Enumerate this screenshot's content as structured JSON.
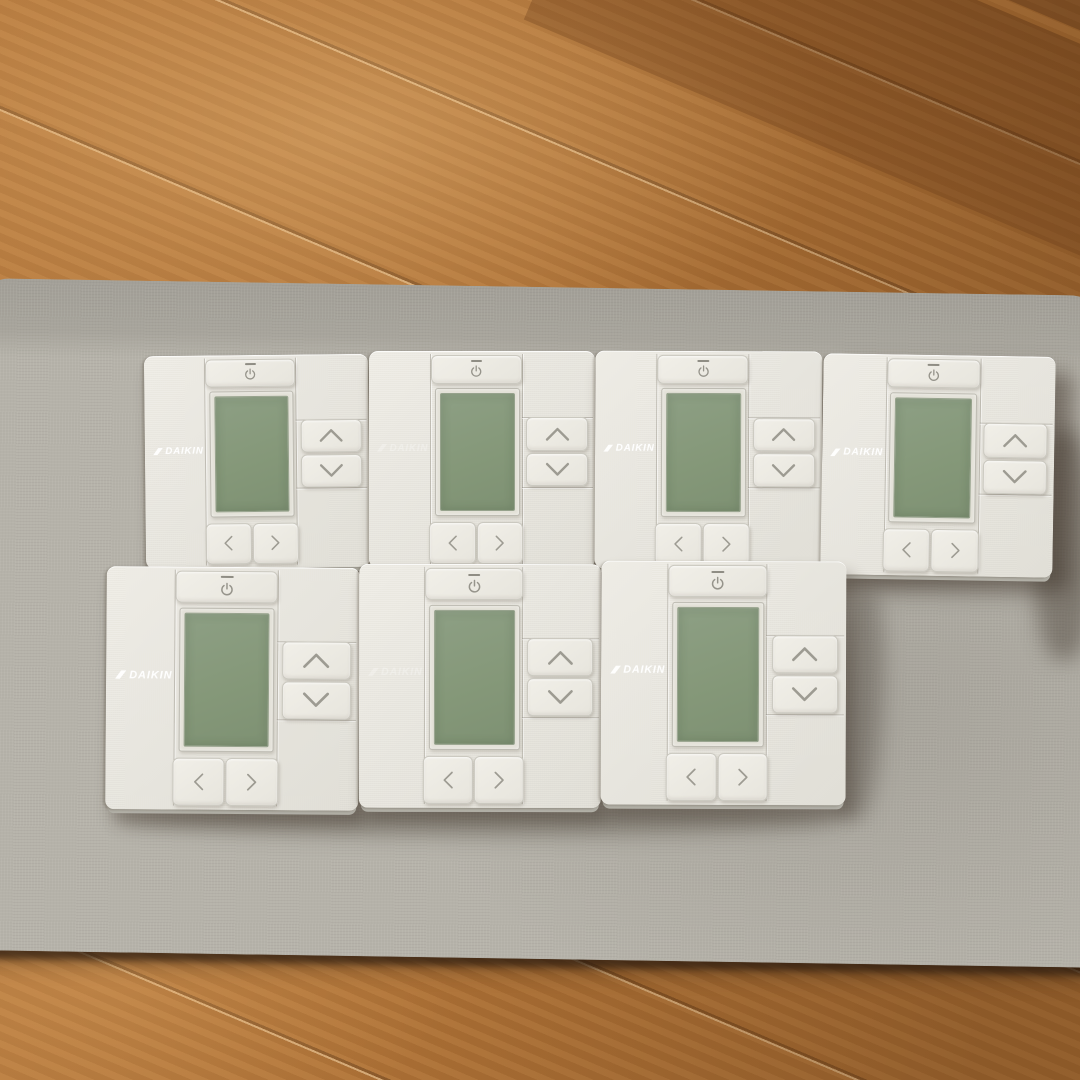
{
  "scene": {
    "description": "Seven DAIKIN wired air-conditioner remote controllers lying face-up on a gray fabric board placed on a brown wooden floor",
    "surface": "gray fabric board",
    "floor": "brown wooden flooring",
    "arrangement": "4 controllers in the top row, 3 controllers in the bottom row"
  },
  "brand": "DAIKIN",
  "controls": {
    "power_label": "power",
    "up_label": "up",
    "down_label": "down",
    "left_label": "left",
    "right_label": "right"
  },
  "display": {
    "state": "off",
    "color": "#85987a"
  },
  "colors": {
    "floor_wood": "#ad7136",
    "floor_wood_dark": "#6e4423",
    "mat_gray": "#b3b0a7",
    "body_white": "#eae8e1",
    "lcd_green": "#85987a",
    "glyph_gray": "#a09e95",
    "logo_white": "#ffffff"
  },
  "controllers": [
    {
      "id": "controller-1",
      "row": 1,
      "col": 1,
      "brand": "DAIKIN",
      "logo_faint": false,
      "display_state": "off"
    },
    {
      "id": "controller-2",
      "row": 1,
      "col": 2,
      "brand": "DAIKIN",
      "logo_faint": true,
      "display_state": "off"
    },
    {
      "id": "controller-3",
      "row": 1,
      "col": 3,
      "brand": "DAIKIN",
      "logo_faint": false,
      "display_state": "off"
    },
    {
      "id": "controller-4",
      "row": 1,
      "col": 4,
      "brand": "DAIKIN",
      "logo_faint": false,
      "display_state": "off"
    },
    {
      "id": "controller-5",
      "row": 2,
      "col": 1,
      "brand": "DAIKIN",
      "logo_faint": false,
      "display_state": "off"
    },
    {
      "id": "controller-6",
      "row": 2,
      "col": 2,
      "brand": "DAIKIN",
      "logo_faint": true,
      "display_state": "off"
    },
    {
      "id": "controller-7",
      "row": 2,
      "col": 3,
      "brand": "DAIKIN",
      "logo_faint": false,
      "display_state": "off"
    }
  ]
}
